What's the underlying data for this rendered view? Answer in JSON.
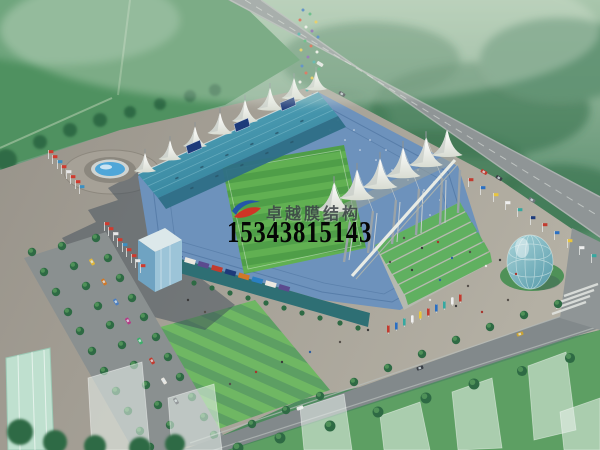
{
  "image": {
    "type": "architectural-rendering",
    "description": "Aerial perspective rendering of a stadium with white tensile membrane roof structures, surrounded by plazas, tree-lined boulevards, roads and a glass dome pavilion"
  },
  "watermark": {
    "company_name": "卓越膜结构",
    "phone_number": "15343815143"
  },
  "scene": {
    "parts": [
      "hazy-tree-backdrop",
      "open-green-field",
      "top-diagonal-road",
      "pedestrian-crowd",
      "stadium-main-roof",
      "west-membrane-tents",
      "east-membrane-tents",
      "steel-masts",
      "green-terraces",
      "striped-pitch",
      "seating-bowl",
      "ad-facade",
      "entrance-block",
      "plaza",
      "fountain",
      "stadium-shadow",
      "red-flag-rows",
      "color-flag-row",
      "banner-flags",
      "boulevard-trees",
      "parked-cars",
      "bottom-road",
      "glass-dome",
      "ghost-buildings",
      "green-glass-building",
      "lawn-bank",
      "people-dots"
    ],
    "palette": {
      "sky-top": "#a9c6ac",
      "trees-haze": "#5d9070",
      "tree-dark": "#2e6a44",
      "tree-light": "#4f9158",
      "field-open": "#4f9160",
      "road": "#8f9596",
      "road-edge": "#bcc2be",
      "plaza": "#98938a",
      "plaza-light": "#b4b0a4",
      "shadow": "#3d4c59",
      "roof-teal": "#5fb0c4",
      "roof-teal-dark": "#2e7d97",
      "fascia": "#2e6f86",
      "tent-white": "#f3f4ee",
      "tent-shade": "#c7ccc7",
      "bowl-blue": "#6d92bc",
      "bowl-dark": "#4b74a4",
      "pitch-green": "#4f9e48",
      "pitch-stripe": "#61b052",
      "terrace-green": "#57b058",
      "facade-teal": "#2e6f74",
      "banner-orange": "#d07828",
      "banner-navy": "#1d3a7a",
      "banner-purple": "#5b4a8e",
      "dome-glass": "#a8d3d8",
      "dome-deep": "#5d9fae",
      "water": "#4fa6d8",
      "grass": "#5d9f63",
      "lawn-light": "#6fb763",
      "ghost": "#e9f3ec",
      "flag-red": "#d03a2e",
      "logo-blue": "#2456a8",
      "logo-red": "#cf3426",
      "text-dark": "#3c4247",
      "phone-black": "#050505"
    }
  }
}
